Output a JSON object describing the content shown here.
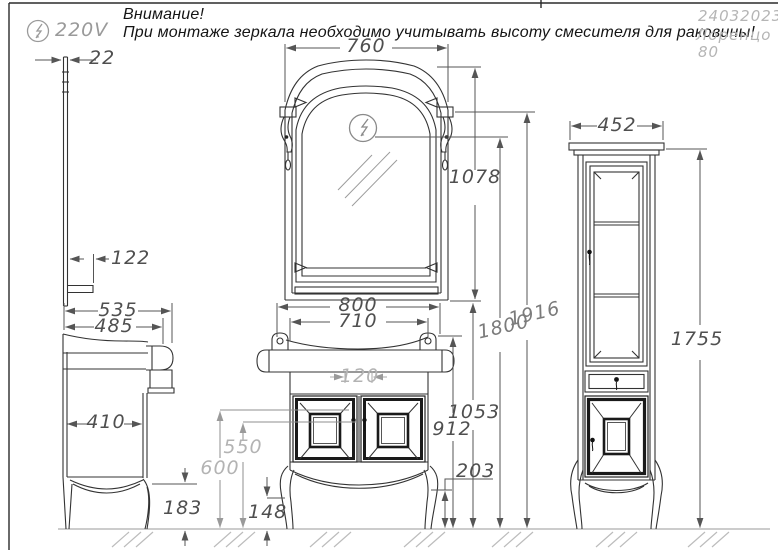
{
  "header": {
    "warning_line1": "Внимание!",
    "warning_line2": "При монтаже зеркала необходимо учитывать высоту смесителя для раковины!",
    "voltage": "220V",
    "date": "24032023",
    "model_name": "Лоренцо",
    "model_size": "80"
  },
  "dimensions": {
    "mirror_profile_thickness": "22",
    "mirror_shelf_depth": "122",
    "side_depth_total": "535",
    "side_depth_counter": "485",
    "side_body_depth": "410",
    "side_leg_height": "183",
    "mirror_width": "760",
    "mirror_height": "1078",
    "vanity_width": "800",
    "vanity_body_width": "710",
    "drain_gap": "120",
    "height_600": "600",
    "height_550": "550",
    "front_apron_height": "148",
    "side_apron_height": "203",
    "counter_height": "912",
    "mirror_bottom_height": "1053",
    "outlet_height": "1800",
    "lamp_height": "1916",
    "cabinet_width": "452",
    "cabinet_height": "1755"
  }
}
